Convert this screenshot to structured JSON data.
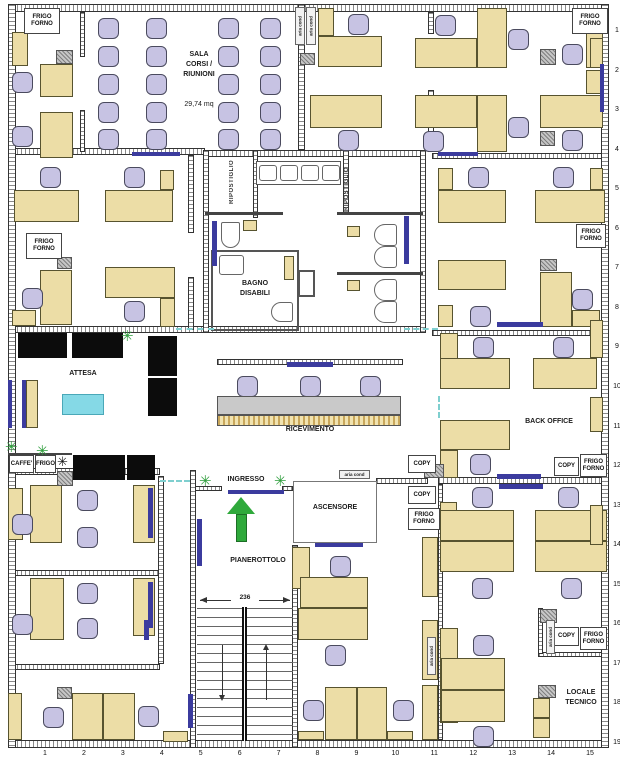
{
  "plan": {
    "icons": {
      "plant": "✳",
      "snowflake": "✳"
    },
    "colors": {
      "desk": "#ecdda6",
      "chair": "#c7c3e3",
      "accent_blue": "#3b3b9e",
      "sofa": "#0c0c0c",
      "table_cyan": "#85d9e6",
      "arrow_green": "#2fa93b"
    },
    "labels": [
      {
        "text": "SALA\nCORSI /\nRIUNIONI",
        "x": 168,
        "y": 50,
        "w": 62
      },
      {
        "text": "29,74 mq",
        "x": 168,
        "y": 100,
        "w": 62,
        "normal": true
      },
      {
        "text": "BAGNO\nDISABILI",
        "x": 213,
        "y": 279,
        "w": 84
      },
      {
        "text": "ATTESA",
        "x": 58,
        "y": 369,
        "w": 50
      },
      {
        "text": "RICEVIMENTO",
        "x": 270,
        "y": 425,
        "w": 80
      },
      {
        "text": "INGRESSO",
        "x": 221,
        "y": 475,
        "w": 50
      },
      {
        "text": "ASCENSORE",
        "x": 300,
        "y": 503,
        "w": 70
      },
      {
        "text": "PIANEROTTOLO",
        "x": 218,
        "y": 556,
        "w": 80
      },
      {
        "text": "BACK OFFICE",
        "x": 509,
        "y": 417,
        "w": 80
      },
      {
        "text": "LOCALE\nTECNICO",
        "x": 551,
        "y": 688,
        "w": 60
      }
    ],
    "vlabels": [
      {
        "text": "RIPOSTIGLIO",
        "x": 229,
        "y": 158,
        "h": 48
      },
      {
        "text": "RIPOSTIGLIO",
        "x": 344,
        "y": 163,
        "h": 52
      }
    ],
    "boxes": [
      {
        "text": "FRIGO\nFORNO",
        "x": 24,
        "y": 8,
        "w": 36,
        "h": 26
      },
      {
        "text": "FRIGO\nFORNO",
        "x": 572,
        "y": 8,
        "w": 36,
        "h": 26
      },
      {
        "text": "FRIGO\nFORNO",
        "x": 26,
        "y": 233,
        "w": 36,
        "h": 26
      },
      {
        "text": "FRIGO\nFORNO",
        "x": 576,
        "y": 224,
        "w": 30,
        "h": 24
      },
      {
        "text": "FRIGO\nFORNO",
        "x": 580,
        "y": 454,
        "w": 27,
        "h": 23
      },
      {
        "text": "FRIGO\nFORNO",
        "x": 408,
        "y": 508,
        "w": 32,
        "h": 22
      },
      {
        "text": "FRIGO\nFORNO",
        "x": 580,
        "y": 627,
        "w": 27,
        "h": 23
      },
      {
        "text": "COPY",
        "x": 408,
        "y": 455,
        "w": 28,
        "h": 18
      },
      {
        "text": "COPY",
        "x": 554,
        "y": 457,
        "w": 25,
        "h": 19
      },
      {
        "text": "COPY",
        "x": 408,
        "y": 486,
        "w": 28,
        "h": 18
      },
      {
        "text": "COPY",
        "x": 554,
        "y": 627,
        "w": 25,
        "h": 19
      },
      {
        "text": "CAFFE'",
        "x": 9,
        "y": 455,
        "w": 25,
        "h": 18
      },
      {
        "text": "FRIGO",
        "x": 35,
        "y": 455,
        "w": 21,
        "h": 18
      }
    ],
    "aria_v": [
      {
        "text": "aria cond",
        "x": 295,
        "y": 7,
        "w": 10,
        "h": 38
      },
      {
        "text": "aria cond",
        "x": 306,
        "y": 7,
        "w": 10,
        "h": 38
      },
      {
        "text": "aria cond",
        "x": 427,
        "y": 637,
        "w": 9,
        "h": 38
      },
      {
        "text": "aria cond",
        "x": 546,
        "y": 620,
        "w": 9,
        "h": 34
      }
    ],
    "aria_h": [
      {
        "text": "aria cond",
        "x": 339,
        "y": 470,
        "w": 31,
        "h": 9
      }
    ],
    "grid_right": {
      "labels": [
        "1",
        "2",
        "3",
        "4",
        "5",
        "6",
        "7",
        "8",
        "9",
        "10",
        "11",
        "12",
        "13",
        "14",
        "15",
        "16",
        "17",
        "18",
        "19"
      ],
      "x": 610,
      "y0": 27,
      "dy": 39.55
    },
    "grid_bottom": {
      "labels": [
        "1",
        "2",
        "3",
        "4",
        "5",
        "6",
        "7",
        "8",
        "9",
        "10",
        "11",
        "12",
        "13",
        "14",
        "15"
      ],
      "y": 750,
      "x0": 38,
      "dx": 38.93
    },
    "walls_h": [
      [
        8,
        4,
        600,
        8
      ],
      [
        8,
        740,
        600,
        8
      ],
      [
        8,
        148,
        197,
        7
      ],
      [
        203,
        150,
        223,
        7
      ],
      [
        432,
        153,
        170,
        6
      ],
      [
        8,
        326,
        197,
        7
      ],
      [
        203,
        326,
        223,
        7
      ],
      [
        432,
        330,
        170,
        6
      ],
      [
        8,
        468,
        152,
        7
      ],
      [
        438,
        477,
        164,
        7
      ],
      [
        376,
        478,
        52,
        6
      ],
      [
        8,
        570,
        152,
        6
      ],
      [
        8,
        664,
        152,
        6
      ],
      [
        538,
        652,
        64,
        5
      ],
      [
        190,
        486,
        32,
        5
      ],
      [
        282,
        486,
        11,
        5
      ],
      [
        217,
        359,
        186,
        6
      ]
    ],
    "walls_v": [
      [
        8,
        4,
        8,
        744
      ],
      [
        601,
        4,
        8,
        744
      ],
      [
        298,
        4,
        7,
        146
      ],
      [
        203,
        150,
        6,
        183
      ],
      [
        420,
        150,
        6,
        183
      ],
      [
        428,
        12,
        6,
        22
      ],
      [
        428,
        90,
        6,
        62
      ],
      [
        438,
        484,
        5,
        256
      ],
      [
        190,
        470,
        6,
        278
      ],
      [
        292,
        545,
        6,
        203
      ],
      [
        253,
        150,
        5,
        68
      ],
      [
        343,
        150,
        6,
        64
      ],
      [
        80,
        12,
        5,
        45
      ],
      [
        80,
        110,
        5,
        42
      ],
      [
        188,
        155,
        6,
        78
      ],
      [
        188,
        277,
        6,
        53
      ],
      [
        158,
        476,
        6,
        188
      ],
      [
        538,
        608,
        5,
        46
      ]
    ],
    "partitions": [
      [
        205,
        212,
        78,
        3
      ],
      [
        337,
        212,
        86,
        3
      ],
      [
        337,
        272,
        86,
        3
      ],
      [
        8,
        453,
        64,
        2
      ]
    ],
    "rooms": [
      {
        "name": "bagno-disabili-room",
        "x": 211,
        "y": 250,
        "w": 88,
        "h": 81
      },
      {
        "name": "ascensore-room",
        "x": 293,
        "y": 481,
        "w": 84,
        "h": 62
      },
      {
        "name": "bagno-shaft",
        "x": 298,
        "y": 270,
        "w": 17,
        "h": 27
      }
    ],
    "desks": [
      [
        12,
        32,
        16,
        34
      ],
      [
        40,
        64,
        33,
        33
      ],
      [
        40,
        112,
        33,
        46
      ],
      [
        318,
        8,
        16,
        28
      ],
      [
        318,
        36,
        64,
        31
      ],
      [
        310,
        95,
        72,
        33
      ],
      [
        415,
        38,
        62,
        30
      ],
      [
        477,
        8,
        30,
        60
      ],
      [
        415,
        95,
        62,
        33
      ],
      [
        477,
        95,
        30,
        57
      ],
      [
        586,
        10,
        17,
        58
      ],
      [
        540,
        95,
        63,
        33
      ],
      [
        586,
        70,
        17,
        24
      ],
      [
        14,
        190,
        65,
        32
      ],
      [
        105,
        190,
        68,
        32
      ],
      [
        160,
        170,
        14,
        20
      ],
      [
        40,
        270,
        32,
        55
      ],
      [
        12,
        310,
        24,
        16
      ],
      [
        105,
        267,
        70,
        31
      ],
      [
        160,
        298,
        15,
        29
      ],
      [
        438,
        168,
        15,
        22
      ],
      [
        438,
        190,
        68,
        33
      ],
      [
        535,
        190,
        70,
        33
      ],
      [
        590,
        168,
        13,
        22
      ],
      [
        438,
        260,
        68,
        30
      ],
      [
        540,
        272,
        32,
        55
      ],
      [
        572,
        310,
        28,
        17
      ],
      [
        438,
        305,
        15,
        22
      ],
      [
        440,
        333,
        18,
        55
      ],
      [
        440,
        358,
        70,
        31
      ],
      [
        533,
        358,
        64,
        31
      ],
      [
        590,
        397,
        13,
        35
      ],
      [
        440,
        420,
        70,
        30
      ],
      [
        440,
        450,
        18,
        28
      ],
      [
        26,
        380,
        12,
        48
      ],
      [
        8,
        488,
        15,
        52
      ],
      [
        30,
        485,
        32,
        58
      ],
      [
        133,
        485,
        22,
        58
      ],
      [
        30,
        578,
        34,
        62
      ],
      [
        133,
        578,
        22,
        58
      ],
      [
        8,
        693,
        14,
        47
      ],
      [
        72,
        693,
        31,
        47
      ],
      [
        103,
        693,
        32,
        47
      ],
      [
        163,
        731,
        25,
        11
      ],
      [
        292,
        547,
        18,
        42
      ],
      [
        300,
        577,
        68,
        31
      ],
      [
        298,
        608,
        70,
        32
      ],
      [
        325,
        687,
        32,
        53
      ],
      [
        357,
        687,
        30,
        53
      ],
      [
        298,
        731,
        26,
        9
      ],
      [
        387,
        731,
        26,
        9
      ],
      [
        422,
        537,
        16,
        60
      ],
      [
        422,
        620,
        16,
        60
      ],
      [
        422,
        685,
        16,
        55
      ],
      [
        440,
        502,
        17,
        40
      ],
      [
        440,
        510,
        74,
        31
      ],
      [
        440,
        541,
        74,
        31
      ],
      [
        535,
        510,
        72,
        31
      ],
      [
        535,
        541,
        72,
        31
      ],
      [
        590,
        505,
        13,
        40
      ],
      [
        440,
        628,
        18,
        95
      ],
      [
        441,
        658,
        64,
        32
      ],
      [
        441,
        690,
        64,
        32
      ],
      [
        533,
        698,
        17,
        20
      ],
      [
        533,
        718,
        17,
        20
      ],
      [
        590,
        38,
        13,
        30
      ],
      [
        590,
        320,
        13,
        38
      ],
      [
        243,
        220,
        14,
        11
      ],
      [
        347,
        226,
        13,
        11
      ],
      [
        347,
        280,
        13,
        11
      ],
      [
        284,
        256,
        10,
        24
      ]
    ],
    "chairs": [
      [
        98,
        18
      ],
      [
        146,
        18
      ],
      [
        218,
        18
      ],
      [
        260,
        18
      ],
      [
        98,
        46
      ],
      [
        146,
        46
      ],
      [
        218,
        46
      ],
      [
        260,
        46
      ],
      [
        98,
        74
      ],
      [
        146,
        74
      ],
      [
        218,
        74
      ],
      [
        260,
        74
      ],
      [
        98,
        102
      ],
      [
        146,
        102
      ],
      [
        218,
        102
      ],
      [
        260,
        102
      ],
      [
        98,
        129
      ],
      [
        146,
        129
      ],
      [
        218,
        129
      ],
      [
        260,
        129
      ],
      [
        12,
        72
      ],
      [
        12,
        126
      ],
      [
        348,
        14
      ],
      [
        338,
        130
      ],
      [
        435,
        15
      ],
      [
        508,
        29
      ],
      [
        423,
        131
      ],
      [
        508,
        117
      ],
      [
        562,
        44
      ],
      [
        562,
        130
      ],
      [
        40,
        167
      ],
      [
        124,
        167
      ],
      [
        22,
        288
      ],
      [
        124,
        301
      ],
      [
        468,
        167
      ],
      [
        553,
        167
      ],
      [
        470,
        306
      ],
      [
        572,
        289
      ],
      [
        473,
        337
      ],
      [
        553,
        337
      ],
      [
        470,
        454
      ],
      [
        237,
        376
      ],
      [
        300,
        376
      ],
      [
        360,
        376
      ],
      [
        12,
        514
      ],
      [
        77,
        490
      ],
      [
        77,
        527
      ],
      [
        12,
        614
      ],
      [
        77,
        583
      ],
      [
        77,
        618
      ],
      [
        43,
        707
      ],
      [
        138,
        706
      ],
      [
        330,
        556
      ],
      [
        325,
        645
      ],
      [
        303,
        700
      ],
      [
        393,
        700
      ],
      [
        472,
        487
      ],
      [
        558,
        487
      ],
      [
        472,
        578
      ],
      [
        561,
        578
      ],
      [
        473,
        635
      ],
      [
        473,
        726
      ]
    ],
    "sofas": [
      [
        18,
        333,
        49,
        25
      ],
      [
        72,
        333,
        51,
        25
      ],
      [
        148,
        336,
        29,
        40
      ],
      [
        148,
        378,
        29,
        38
      ],
      [
        73,
        455,
        52,
        25
      ],
      [
        127,
        455,
        28,
        25
      ]
    ],
    "gray_boxes": [
      [
        56,
        50,
        17,
        14
      ],
      [
        300,
        53,
        15,
        12
      ],
      [
        540,
        49,
        16,
        16
      ],
      [
        540,
        131,
        15,
        15
      ],
      [
        57,
        257,
        15,
        12
      ],
      [
        540,
        259,
        17,
        12
      ],
      [
        57,
        471,
        16,
        15
      ],
      [
        424,
        464,
        20,
        14
      ],
      [
        540,
        609,
        17,
        14
      ],
      [
        538,
        685,
        18,
        13
      ],
      [
        57,
        687,
        15,
        12
      ]
    ],
    "blue_marks": [
      [
        132,
        152,
        48,
        4
      ],
      [
        600,
        64,
        4,
        48
      ],
      [
        438,
        152,
        40,
        4
      ],
      [
        497,
        322,
        46,
        5
      ],
      [
        497,
        474,
        44,
        5
      ],
      [
        499,
        484,
        44,
        5
      ],
      [
        212,
        221,
        5,
        45
      ],
      [
        404,
        216,
        5,
        48
      ],
      [
        8,
        380,
        4,
        48
      ],
      [
        22,
        380,
        4,
        48
      ],
      [
        287,
        362,
        46,
        5
      ],
      [
        228,
        490,
        56,
        4
      ],
      [
        315,
        543,
        48,
        4
      ],
      [
        197,
        519,
        5,
        47
      ],
      [
        188,
        694,
        5,
        34
      ],
      [
        148,
        488,
        5,
        50
      ],
      [
        148,
        582,
        5,
        46
      ],
      [
        144,
        620,
        5,
        20
      ]
    ],
    "plants": [
      [
        121,
        329
      ],
      [
        5,
        440
      ],
      [
        36,
        444
      ],
      [
        199,
        474
      ],
      [
        274,
        474
      ]
    ],
    "snowflakes": [
      [
        57,
        455
      ]
    ],
    "dashes_h": [
      [
        160,
        480,
        30
      ],
      [
        176,
        328,
        38
      ],
      [
        404,
        328,
        34
      ]
    ],
    "dashes_v": [
      [
        438,
        396,
        22
      ]
    ],
    "cyan_table": [
      62,
      394,
      42,
      21
    ],
    "wcs": [
      {
        "r": [
          374,
          224,
          23,
          22
        ],
        "side": "left"
      },
      {
        "r": [
          374,
          246,
          23,
          22
        ],
        "side": "left"
      },
      {
        "r": [
          374,
          279,
          23,
          22
        ],
        "side": "left"
      },
      {
        "r": [
          374,
          301,
          23,
          22
        ],
        "side": "left"
      },
      {
        "r": [
          271,
          302,
          22,
          20
        ],
        "side": "left"
      },
      {
        "r": [
          221,
          222,
          19,
          26
        ],
        "side": "bottom"
      }
    ],
    "bagno_sink": [
      219,
      255,
      25,
      20
    ],
    "sink_counter": {
      "r": [
        256,
        161,
        85,
        24
      ],
      "sinks": [
        [
          259,
          165,
          18,
          16
        ],
        [
          280,
          165,
          18,
          16
        ],
        [
          301,
          165,
          18,
          16
        ],
        [
          322,
          165,
          18,
          16
        ]
      ]
    },
    "reception": {
      "counter_gray": [
        217,
        396,
        184,
        19
      ],
      "counter_front": [
        217,
        415,
        184,
        11
      ]
    },
    "stairs": {
      "treads": [
        197,
        608,
        96,
        132
      ],
      "rail": [
        242,
        607,
        5,
        134
      ],
      "arrow_down": {
        "x": 222,
        "y": 645,
        "len": 50
      },
      "arrow_up": {
        "x": 266,
        "y": 650,
        "len": 50
      }
    },
    "dimension": {
      "label": "236",
      "x1": 200,
      "x2": 290,
      "y": 600
    },
    "entry_arrow": {
      "x": 227,
      "y": 497,
      "head_w": 28,
      "head_h": 17,
      "stem_w": 11,
      "stem_h": 28
    }
  }
}
